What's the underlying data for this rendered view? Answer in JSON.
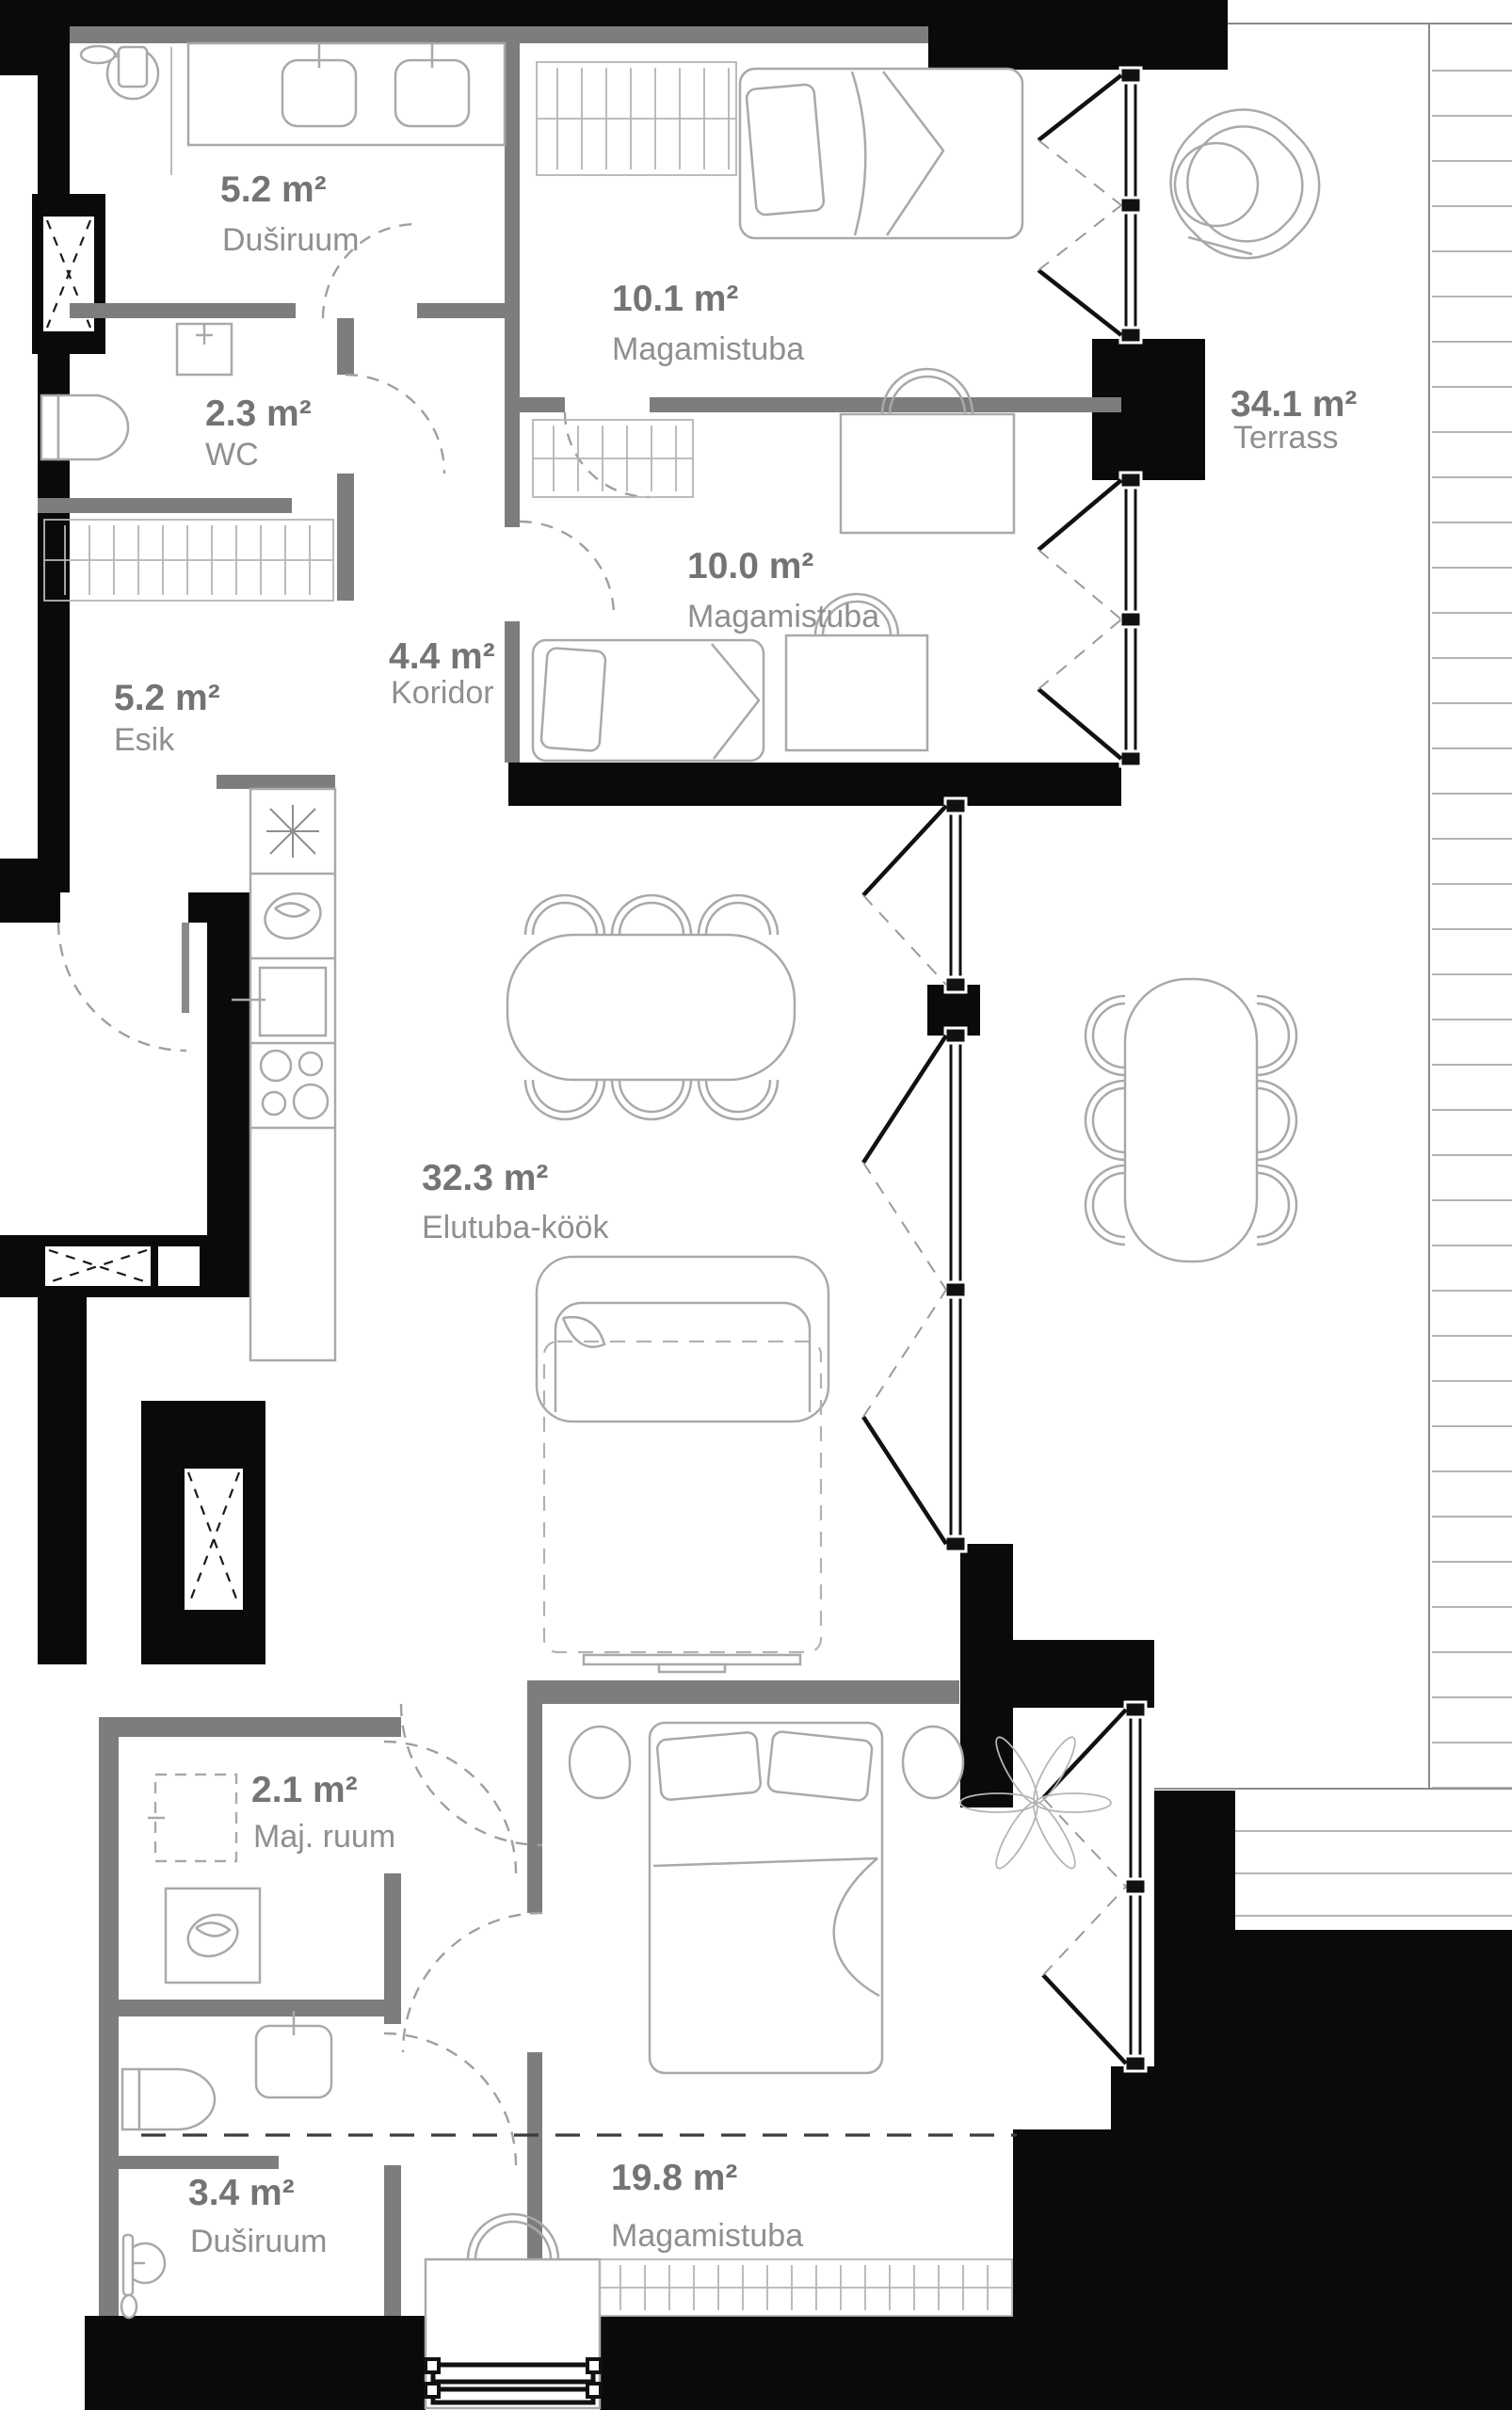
{
  "plan": {
    "type": "apartment-floor-plan",
    "language": "Estonian",
    "area_unit": "m²",
    "colors": {
      "exterior_wall": "#0a0a0a",
      "interior_wall": "#7d7d7d",
      "furniture_stroke": "#a9a9a9",
      "area_number_text": "#747474",
      "room_label_text": "#8f8f8f"
    },
    "rooms": [
      {
        "id": "dusiruum-top",
        "area": "5.2 m²",
        "name": "Duširuum"
      },
      {
        "id": "magamistuba-1",
        "area": "10.1 m²",
        "name": "Magamistuba"
      },
      {
        "id": "wc",
        "area": "2.3 m²",
        "name": "WC"
      },
      {
        "id": "magamistuba-2",
        "area": "10.0 m²",
        "name": "Magamistuba"
      },
      {
        "id": "koridor",
        "area": "4.4 m²",
        "name": "Koridor"
      },
      {
        "id": "esik",
        "area": "5.2 m²",
        "name": "Esik"
      },
      {
        "id": "terrass",
        "area": "34.1 m²",
        "name": "Terrass"
      },
      {
        "id": "elutuba-kook",
        "area": "32.3 m²",
        "name": "Elutuba-köök"
      },
      {
        "id": "maj-ruum",
        "area": "2.1 m²",
        "name": "Maj. ruum"
      },
      {
        "id": "magamistuba-3",
        "area": "19.8 m²",
        "name": "Magamistuba"
      },
      {
        "id": "dusiruum-bottom",
        "area": "3.4 m²",
        "name": "Duširuum"
      }
    ]
  }
}
